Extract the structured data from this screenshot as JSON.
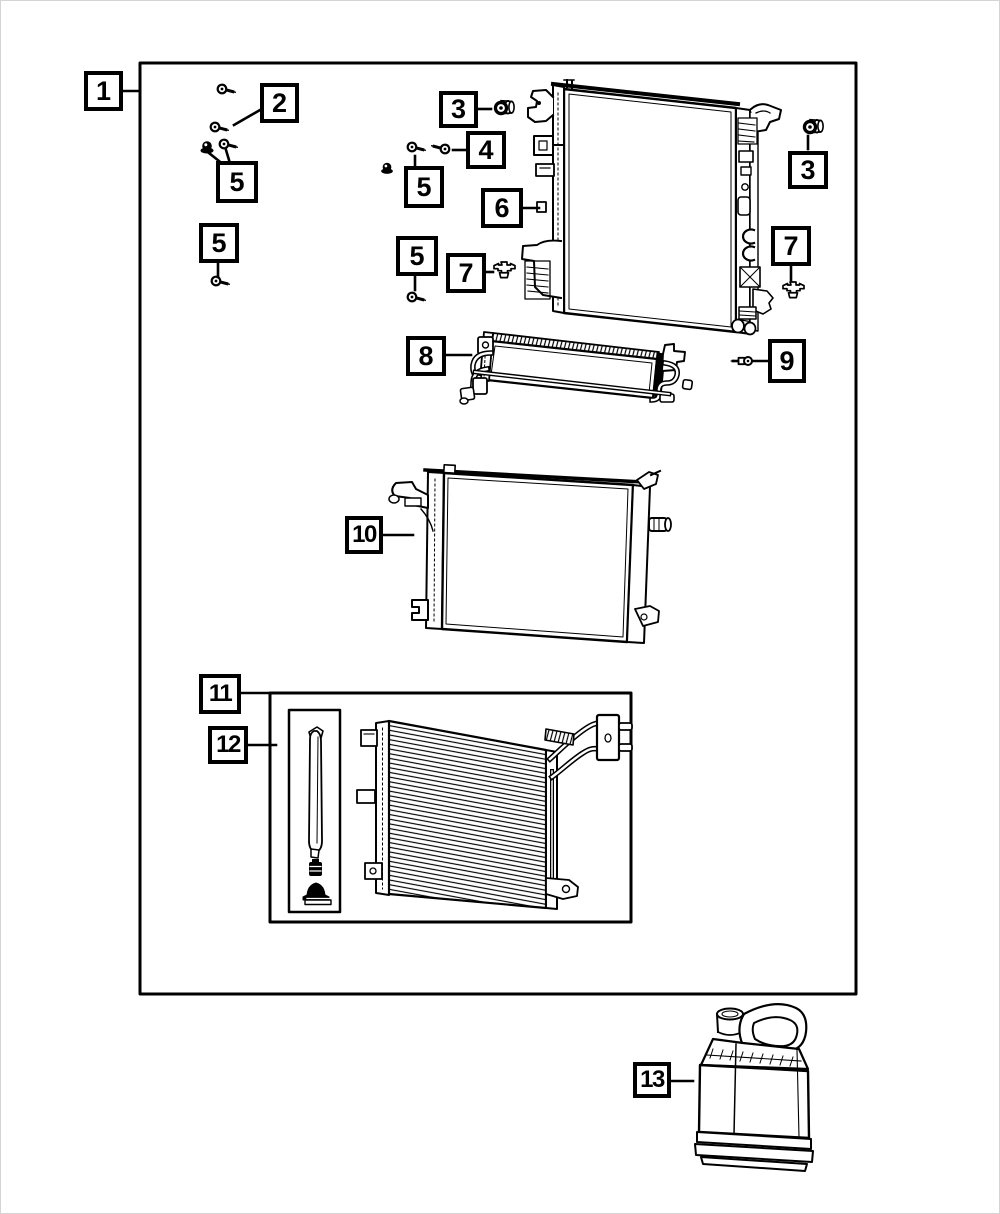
{
  "colors": {
    "ink": "#000000",
    "paper": "#ffffff",
    "image_border": "#d4d4d4"
  },
  "callouts": [
    {
      "id": "1",
      "label": "1"
    },
    {
      "id": "2",
      "label": "2"
    },
    {
      "id": "3-left",
      "label": "3"
    },
    {
      "id": "4",
      "label": "4"
    },
    {
      "id": "5-top",
      "label": "5"
    },
    {
      "id": "5-left",
      "label": "5"
    },
    {
      "id": "5-mid-upper",
      "label": "5"
    },
    {
      "id": "5-mid-lower",
      "label": "5"
    },
    {
      "id": "6",
      "label": "6"
    },
    {
      "id": "3-right",
      "label": "3"
    },
    {
      "id": "7-mid",
      "label": "7"
    },
    {
      "id": "7-right",
      "label": "7"
    },
    {
      "id": "8",
      "label": "8"
    },
    {
      "id": "9",
      "label": "9"
    },
    {
      "id": "10",
      "label": "10"
    },
    {
      "id": "11",
      "label": "11"
    },
    {
      "id": "12",
      "label": "12"
    },
    {
      "id": "13",
      "label": "13"
    }
  ],
  "parts": [
    "radiator-assembly",
    "mounting-screw",
    "grommet",
    "mounting-screw-long",
    "nut-and-screw",
    "radiator",
    "retainer-clip",
    "transmission-oil-cooler",
    "sensor-screw",
    "secondary-radiator",
    "ac-condenser-kit",
    "receiver-drier-kit",
    "coolant-jug"
  ]
}
